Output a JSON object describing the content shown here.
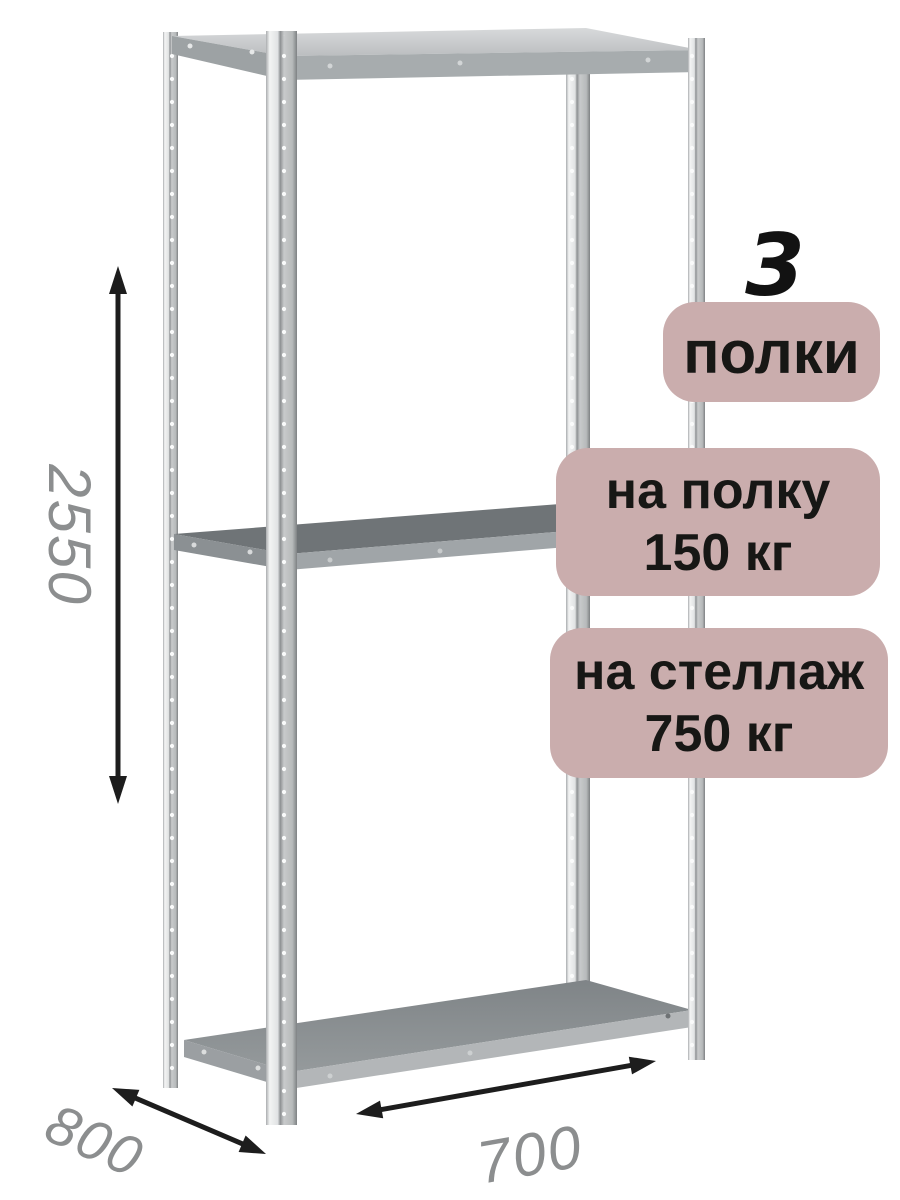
{
  "badges": {
    "count": "3",
    "shelves_label": "полки",
    "shelf_load_line1": "на полку",
    "shelf_load_line2": "150 кг",
    "rack_load_line1": "на стеллаж",
    "rack_load_line2": "750 кг"
  },
  "dimensions": {
    "height_mm": "2550",
    "depth_mm": "800",
    "width_mm": "700"
  },
  "colors": {
    "badge_bg": "#caadad",
    "badge_text": "#171715",
    "count_text": "#121212",
    "dimension_text": "#8c8e8f",
    "arrow": "#1d1d1d",
    "metal_light": "#f2f3f3",
    "metal_dark": "#8e9193",
    "shelf_surface_top": "#c6c9cb",
    "shelf_surface_middle": "#6f7477",
    "shelf_surface_bottom": "#8b9093"
  }
}
